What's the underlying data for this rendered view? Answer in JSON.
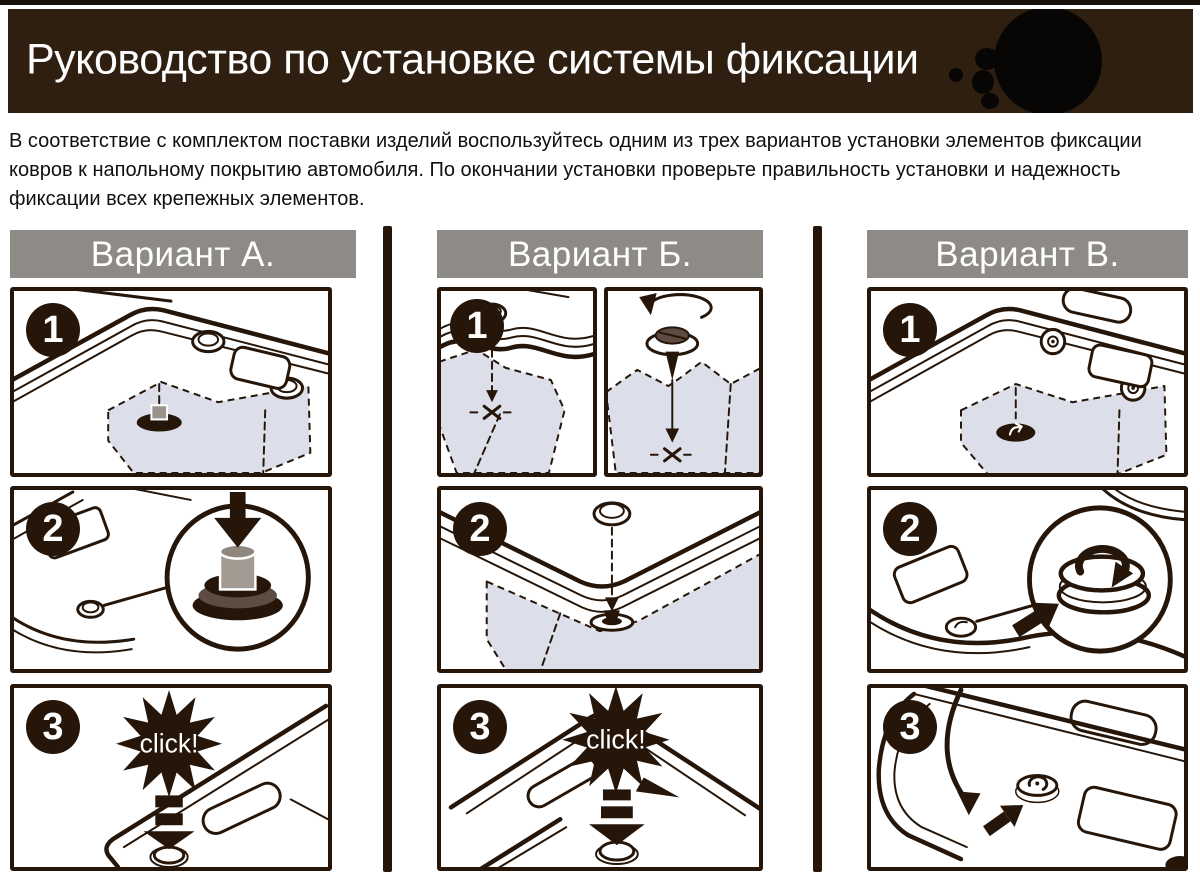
{
  "header": {
    "title": "Руководство по установке системы фиксации"
  },
  "intro": {
    "text": "В соответствие с комплектом поставки изделий воспользуйтесь одним из трех вариантов установки элементов фиксации ковров к напольному покрытию автомобиля. По окончании установки проверьте правильность установки и надежность фиксации всех крепежных элементов."
  },
  "variants": [
    {
      "label": "Вариант А.",
      "step_numbers": [
        "1",
        "2",
        "3"
      ],
      "click_label": "click!"
    },
    {
      "label": "Вариант Б.",
      "step_numbers": [
        "1",
        "2",
        "3"
      ],
      "click_label": "click!"
    },
    {
      "label": "Вариант В.",
      "step_numbers": [
        "1",
        "2",
        "3"
      ]
    }
  ],
  "colors": {
    "header_bg": "#2e1f11",
    "ink": "#261609",
    "variant_bar_bg": "#8e8b86",
    "carpet_fill": "#dcdfe9",
    "text": "#101010"
  }
}
